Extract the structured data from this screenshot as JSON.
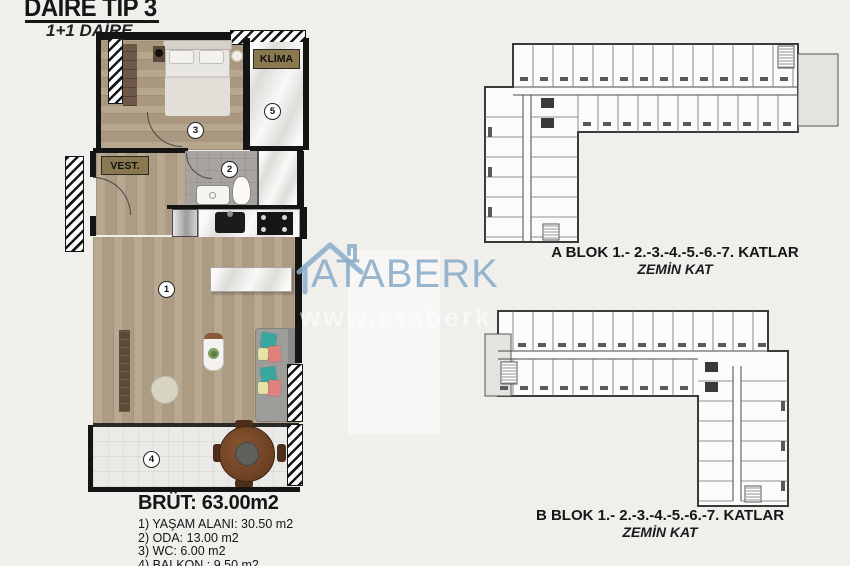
{
  "title": {
    "main": "DAİRE TİP 3",
    "sub": "1+1 DAİRE"
  },
  "plan": {
    "klima_label": "KLİMA",
    "vest_label": "VEST.",
    "room_numbers": {
      "living": "1",
      "bath": "2",
      "bedroom": "3",
      "balcony": "4",
      "klima_balcony": "5"
    }
  },
  "legend": {
    "brut": "BRÜT: 63.00m2",
    "items": [
      "1) YAŞAM ALANI: 30.50 m2",
      "2) ODA: 13.00 m2",
      "3) WC: 6.00 m2",
      "4) BALKON : 9.50 m2"
    ]
  },
  "blocks": {
    "a": {
      "caption": "A BLOK 1.- 2.-3.-4.-5.-6.-7. KATLAR",
      "floor_label": "ZEMİN KAT"
    },
    "b": {
      "caption": "B BLOK 1.- 2.-3.-4.-5.-6.-7. KATLAR",
      "floor_label": "ZEMİN KAT"
    }
  },
  "watermark": {
    "brand": "ATABERK",
    "url_text": "www.ataberk",
    "color": "#8aaCc9"
  },
  "colors": {
    "label_olive": "#8a7950",
    "wall_black": "#141414",
    "background": "#f0efec"
  }
}
